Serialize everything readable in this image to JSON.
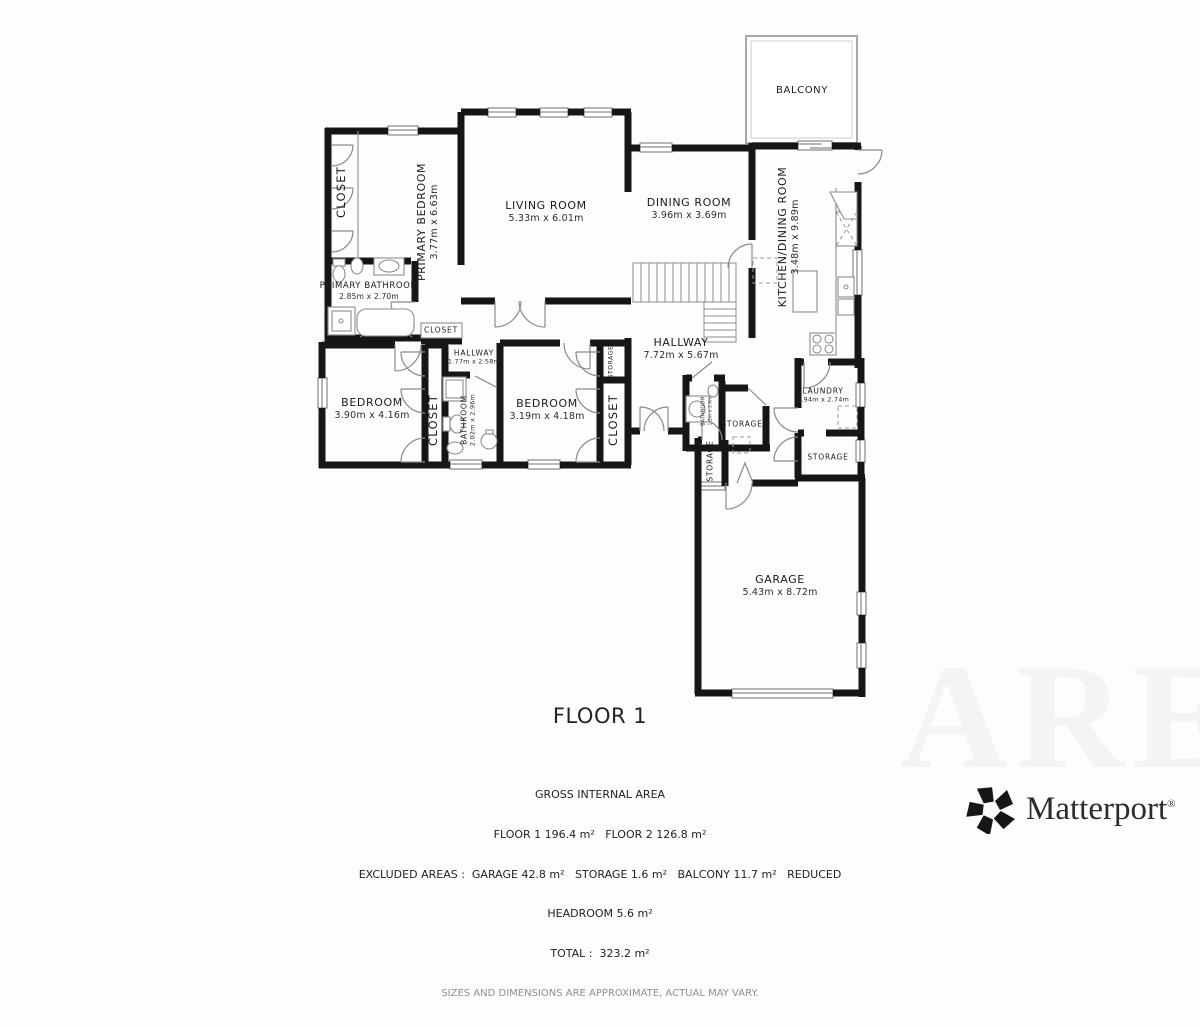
{
  "title": "FLOOR 1",
  "watermark": "ARE",
  "brand": {
    "wordmark": "Matterport",
    "registered": "®"
  },
  "summary": {
    "lines": [
      "GROSS INTERNAL AREA",
      "FLOOR 1 196.4 m²   FLOOR 2 126.8 m²",
      "EXCLUDED AREAS :  GARAGE 42.8 m²   STORAGE 1.6 m²   BALCONY 11.7 m²   REDUCED",
      "HEADROOM 5.6 m²",
      "TOTAL :  323.2 m²"
    ],
    "disclaimer": "SIZES AND DIMENSIONS ARE APPROXIMATE, ACTUAL MAY VARY."
  },
  "rooms": [
    {
      "name": "CLOSET",
      "dims": "",
      "x": 341,
      "y": 192,
      "rot": true,
      "size": "cv"
    },
    {
      "name": "PRIMARY BEDROOM",
      "dims": "3.77m x 6.63m",
      "x": 428,
      "y": 222,
      "rot": true,
      "size": "lg"
    },
    {
      "name": "LIVING ROOM",
      "dims": "5.33m x 6.01m",
      "x": 546,
      "y": 212,
      "rot": false,
      "size": "lg"
    },
    {
      "name": "DINING ROOM",
      "dims": "3.96m x 3.69m",
      "x": 689,
      "y": 209,
      "rot": false,
      "size": "lg"
    },
    {
      "name": "BALCONY",
      "dims": "",
      "x": 802,
      "y": 91,
      "rot": false,
      "size": "md"
    },
    {
      "name": "KITCHEN/DINING ROOM",
      "dims": "3.48m x 9.89m",
      "x": 789,
      "y": 237,
      "rot": true,
      "size": "lg"
    },
    {
      "name": "PRIMARY BATHROOM",
      "dims": "2.85m x 2.70m",
      "x": 369,
      "y": 291,
      "rot": false,
      "size": "sm"
    },
    {
      "name": "CLOSET",
      "dims": "",
      "x": 441,
      "y": 330,
      "rot": false,
      "size": "xs"
    },
    {
      "name": "HALLWAY",
      "dims": "1.77m x 2.58m",
      "x": 474,
      "y": 357,
      "rot": false,
      "size": "xs"
    },
    {
      "name": "HALLWAY",
      "dims": "7.72m x 5.67m",
      "x": 681,
      "y": 349,
      "rot": false,
      "size": "lg"
    },
    {
      "name": "BEDROOM",
      "dims": "3.90m x 4.16m",
      "x": 372,
      "y": 409,
      "rot": false,
      "size": "lg"
    },
    {
      "name": "CLOSET",
      "dims": "",
      "x": 433,
      "y": 420,
      "rot": true,
      "size": "cv"
    },
    {
      "name": "BATHROOM",
      "dims": "2.02m x 2.96m",
      "x": 468,
      "y": 420,
      "rot": true,
      "size": "xs"
    },
    {
      "name": "BEDROOM",
      "dims": "3.19m x 4.18m",
      "x": 547,
      "y": 410,
      "rot": false,
      "size": "lg"
    },
    {
      "name": "STORAGE",
      "dims": "",
      "x": 611,
      "y": 362,
      "rot": true,
      "size": "xxs"
    },
    {
      "name": "CLOSET",
      "dims": "",
      "x": 613,
      "y": 420,
      "rot": true,
      "size": "cv"
    },
    {
      "name": "BATHROOM",
      "dims": "1.2m x 1.4m",
      "x": 707,
      "y": 411,
      "rot": true,
      "size": "tiny"
    },
    {
      "name": "STORAGE",
      "dims": "",
      "x": 742,
      "y": 424,
      "rot": false,
      "size": "xs"
    },
    {
      "name": "LAUNDRY",
      "dims": "1.94m x 2.74m",
      "x": 823,
      "y": 395,
      "rot": false,
      "size": "xs"
    },
    {
      "name": "STORAGE",
      "dims": "",
      "x": 828,
      "y": 457,
      "rot": false,
      "size": "xs"
    },
    {
      "name": "STORAGE",
      "dims": "",
      "x": 710,
      "y": 461,
      "rot": true,
      "size": "xs"
    },
    {
      "name": "GARAGE",
      "dims": "5.43m x 8.72m",
      "x": 780,
      "y": 586,
      "rot": false,
      "size": "lg"
    }
  ]
}
